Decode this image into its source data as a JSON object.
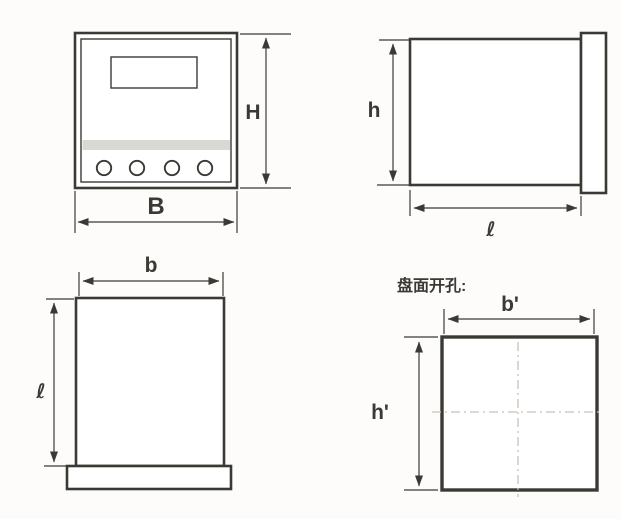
{
  "diagram": {
    "front_view": {
      "height_label": "H",
      "width_label": "B"
    },
    "side_view": {
      "height_label": "h",
      "length_label": "ℓ"
    },
    "rear_view": {
      "width_label": "b",
      "length_label": "ℓ"
    },
    "cutout_view": {
      "title": "盘面开孔:",
      "width_label": "b'",
      "height_label": "h'"
    }
  },
  "colors": {
    "line": "#3a3a35",
    "band": "#d9d8d3",
    "centerline": "#c9c1b3",
    "paper": "#fdfcfa"
  }
}
